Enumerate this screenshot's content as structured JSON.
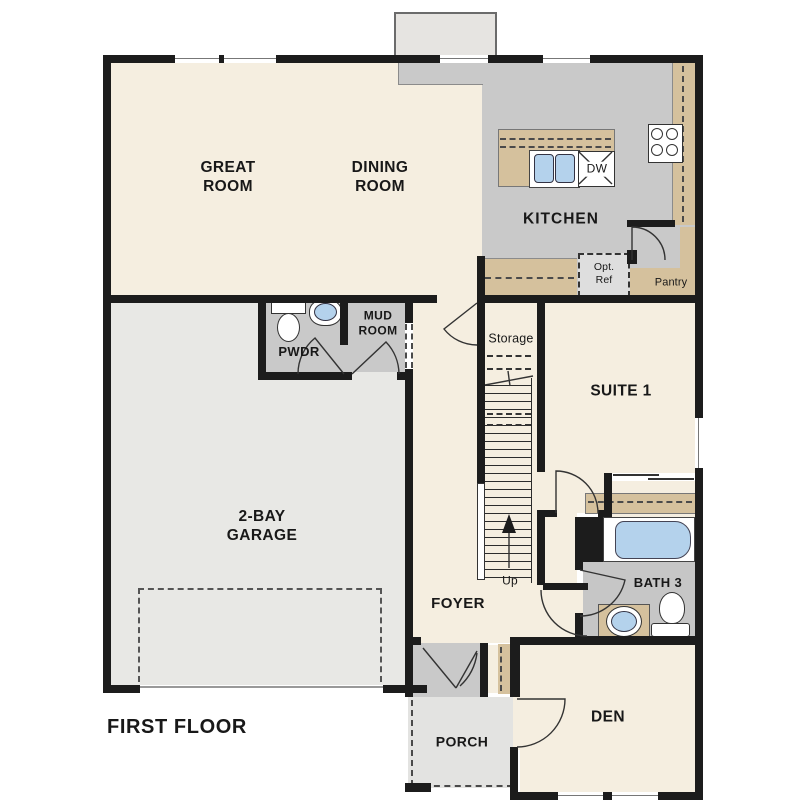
{
  "plan": {
    "title": "FIRST FLOOR",
    "labels": {
      "great_room": "GREAT\nROOM",
      "dining_room": "DINING\nROOM",
      "kitchen": "KITCHEN",
      "dw": "DW",
      "opt_ref": "Opt.\nRef",
      "pantry": "Pantry",
      "mud_room": "MUD\nROOM",
      "pwdr": "PWDR",
      "storage": "Storage",
      "suite1": "SUITE 1",
      "garage": "2-BAY\nGARAGE",
      "foyer": "FOYER",
      "up": "Up",
      "bath3": "BATH 3",
      "den": "DEN",
      "porch": "PORCH"
    },
    "colors": {
      "wall": "#1c1c1c",
      "room_cream": "#f5eee0",
      "kitchen_gray": "#c9c9c9",
      "bath_gray": "#c6c6c6",
      "garage_gray": "#e8e8e5",
      "porch_gray": "#e3e3e1",
      "counter_tan": "#d5c19d",
      "fixture_blue": "#b4d2ec",
      "bumpout_gray": "#e6e4e1"
    }
  }
}
